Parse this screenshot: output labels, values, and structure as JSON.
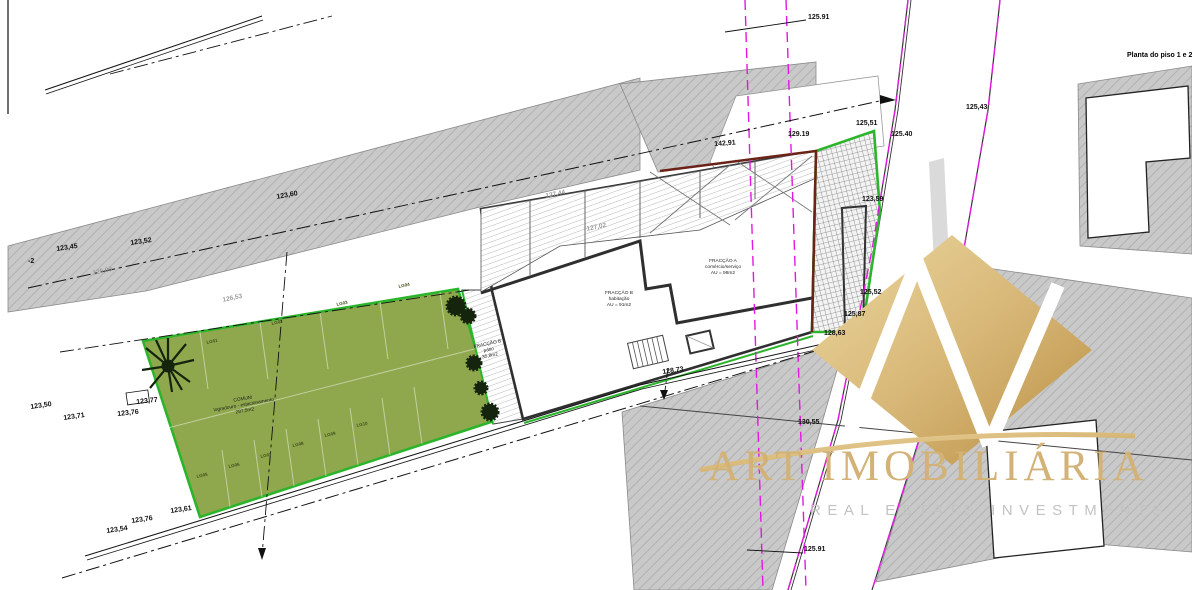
{
  "title": "Planta do piso 1 e 2",
  "watermark": {
    "brand": "ART IMOBILIÁRIA",
    "tagline": "REAL ESTATE INVESTMENTS"
  },
  "colors": {
    "green_area": "#8fa84d",
    "green_border": "#2cb52c",
    "gray_hatch": "#c9c9c9",
    "magenta_boundary": "#e217e2",
    "wall_dark": "#2f2f2f",
    "wall_red": "#6b2317",
    "watermark_gold": "#d3b277"
  },
  "area_labels": [
    {
      "x": 723,
      "y": 268,
      "r": 0,
      "lines": [
        "FRACÇÃO A",
        "comércio/serviço",
        "AU = 98m2"
      ]
    },
    {
      "x": 619,
      "y": 300,
      "r": 0,
      "lines": [
        "FRACÇÃO B",
        "habitação",
        "AU = 91m2"
      ]
    },
    {
      "x": 489,
      "y": 351,
      "r": -12,
      "lines": [
        "FRACÇÃO B",
        "pátio",
        "35,8m2"
      ]
    },
    {
      "x": 244,
      "y": 406,
      "r": -10,
      "lines": [
        "COMUM",
        "logradouro - estacionamento",
        "297,5m2"
      ]
    }
  ],
  "parking": {
    "labels": [
      {
        "t": "LG01",
        "x": 206,
        "y": 340
      },
      {
        "t": "LG02",
        "x": 271,
        "y": 321
      },
      {
        "t": "LG03",
        "x": 336,
        "y": 302
      },
      {
        "t": "LG04",
        "x": 398,
        "y": 284
      },
      {
        "t": "LG05",
        "x": 196,
        "y": 474
      },
      {
        "t": "LG06",
        "x": 228,
        "y": 464
      },
      {
        "t": "LG07",
        "x": 260,
        "y": 454
      },
      {
        "t": "LG08",
        "x": 292,
        "y": 443
      },
      {
        "t": "LG09",
        "x": 324,
        "y": 433
      },
      {
        "t": "LG10",
        "x": 356,
        "y": 423
      }
    ]
  },
  "elevations": [
    {
      "t": "125.91",
      "x": 808,
      "y": 14,
      "r": 0
    },
    {
      "t": "125,43",
      "x": 966,
      "y": 104,
      "r": 0
    },
    {
      "t": "125,51",
      "x": 856,
      "y": 120,
      "r": 0
    },
    {
      "t": "125.40",
      "x": 891,
      "y": 131,
      "r": 0
    },
    {
      "t": "129.19",
      "x": 788,
      "y": 131,
      "r": 0
    },
    {
      "t": "142,91",
      "x": 714,
      "y": 141,
      "r": -4
    },
    {
      "t": "123,60",
      "x": 276,
      "y": 194,
      "r": -10
    },
    {
      "t": "123,45",
      "x": 56,
      "y": 246,
      "r": -8
    },
    {
      "t": "123,52",
      "x": 130,
      "y": 240,
      "r": -8
    },
    {
      "t": "-2",
      "x": 28,
      "y": 258,
      "r": 0
    },
    {
      "t": "126,09",
      "x": 92,
      "y": 270,
      "r": -12,
      "g": 1
    },
    {
      "t": "126,53",
      "x": 222,
      "y": 297,
      "r": -12,
      "g": 1
    },
    {
      "t": "127,44",
      "x": 545,
      "y": 193,
      "r": -12,
      "g": 1
    },
    {
      "t": "127,02",
      "x": 586,
      "y": 226,
      "r": -12,
      "g": 1
    },
    {
      "t": "123,50",
      "x": 30,
      "y": 404,
      "r": -8
    },
    {
      "t": "123,71",
      "x": 63,
      "y": 415,
      "r": -8
    },
    {
      "t": "123,76",
      "x": 117,
      "y": 411,
      "r": -6
    },
    {
      "t": "123,77",
      "x": 136,
      "y": 399,
      "r": -6
    },
    {
      "t": "123,59",
      "x": 862,
      "y": 196,
      "r": 0
    },
    {
      "t": "125,52",
      "x": 860,
      "y": 289,
      "r": 0
    },
    {
      "t": "125,87",
      "x": 844,
      "y": 311,
      "r": 0
    },
    {
      "t": "128,63",
      "x": 824,
      "y": 330,
      "r": 0
    },
    {
      "t": "128,73",
      "x": 662,
      "y": 369,
      "r": -8
    },
    {
      "t": "130,55",
      "x": 798,
      "y": 419,
      "r": 0
    },
    {
      "t": "125.91",
      "x": 804,
      "y": 546,
      "r": 0
    },
    {
      "t": "123,61",
      "x": 170,
      "y": 508,
      "r": -8
    },
    {
      "t": "123,76",
      "x": 131,
      "y": 518,
      "r": -8
    },
    {
      "t": "123,54",
      "x": 106,
      "y": 528,
      "r": -8
    }
  ]
}
